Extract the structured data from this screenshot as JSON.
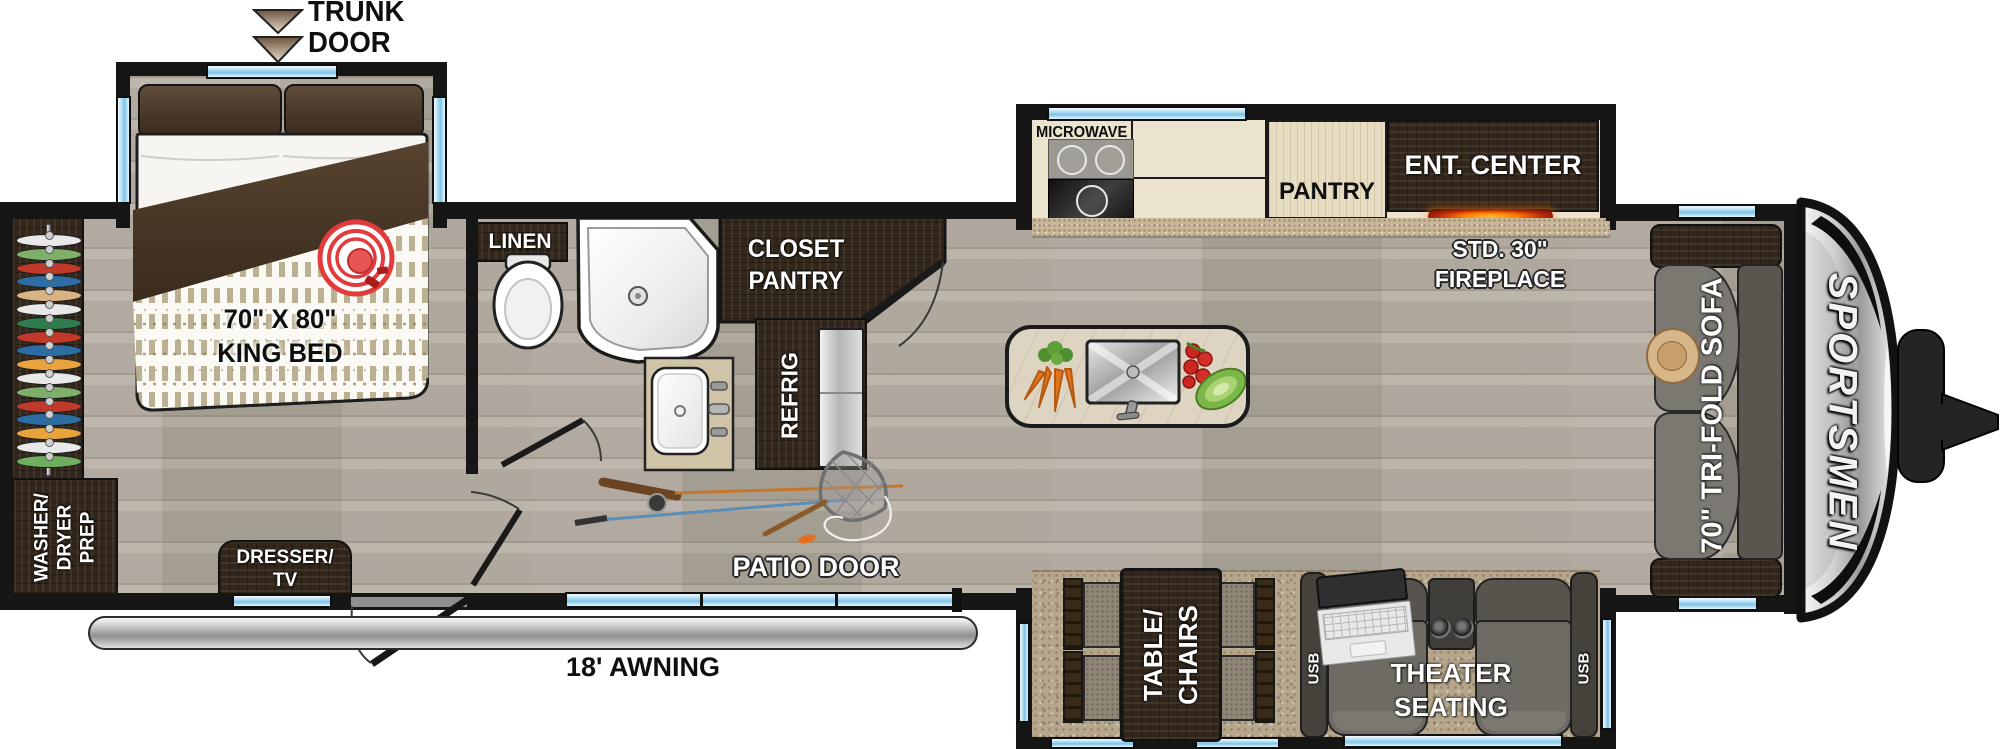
{
  "title": "Travel trailer floor plan",
  "brand": "SPORTSMEN",
  "colors": {
    "wall": "#161616",
    "window_blue": "#8ecdec",
    "dark_wood": "#33271b",
    "light_wood": "#e7ddc3",
    "counter": "#ece3cf",
    "carpet": "#b5a68c",
    "wood_floor": "#b4aca0",
    "fireplace_glow": "#ff7a00",
    "target_red": "#e23b3b"
  },
  "labels": {
    "trunk_door": {
      "line1": "TRUNK",
      "line2": "DOOR"
    },
    "king_bed": {
      "line1": "70\" X 80\"",
      "line2": "KING BED"
    },
    "washer_dryer": {
      "line1": "WASHER/",
      "line2": "DRYER",
      "line3": "PREP"
    },
    "dresser_tv": {
      "line1": "DRESSER/",
      "line2": "TV"
    },
    "linen": "LINEN",
    "closet_pantry": {
      "line1": "CLOSET",
      "line2": "PANTRY"
    },
    "refrig": "REFRIG",
    "microwave": "MICROWAVE",
    "pantry": "PANTRY",
    "ent_center": "ENT. CENTER",
    "fireplace": {
      "line1": "STD. 30\"",
      "line2": "FIREPLACE"
    },
    "sofa": "70\" TRI-FOLD SOFA",
    "patio_door": "PATIO DOOR",
    "awning": "18' AWNING",
    "table_chairs": {
      "line1": "TABLE/",
      "line2": "CHAIRS"
    },
    "theater_seating": {
      "line1": "THEATER",
      "line2": "SEATING"
    },
    "usb_left": "USB",
    "usb_right": "USB",
    "brand": "SPORTSMEN"
  },
  "hangers": {
    "colors": [
      "#e8e8e8",
      "#7fb069",
      "#c0392b",
      "#2e6da4",
      "#d9b382",
      "#e8e8e8",
      "#2f7d4f",
      "#c0392b",
      "#2e6da4",
      "#e8a33d",
      "#e8e8e8",
      "#7fb069",
      "#c0392b",
      "#2e6da4",
      "#e8a33d",
      "#e8e8e8",
      "#6fae5c"
    ]
  }
}
